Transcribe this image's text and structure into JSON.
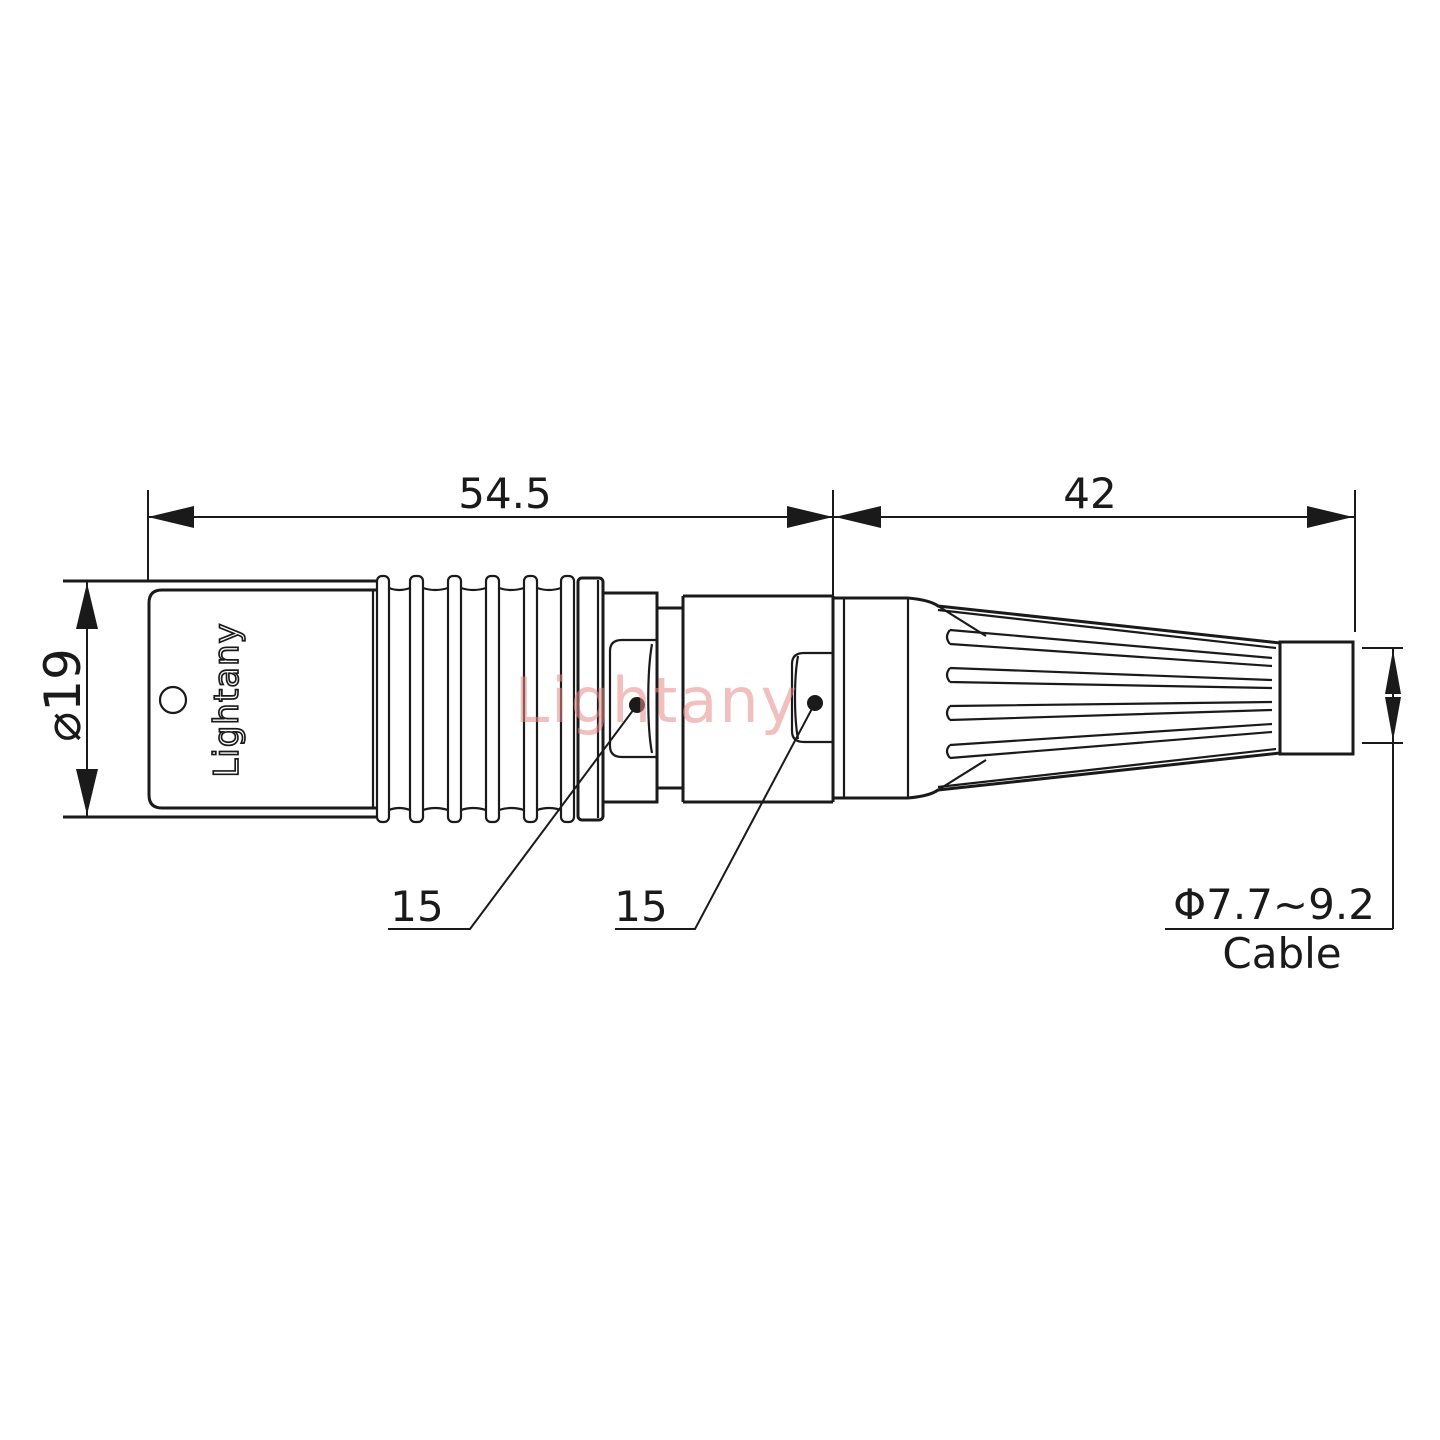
{
  "drawing": {
    "type": "connector-technical-drawing",
    "dimensions": {
      "front_length": "54.5",
      "rear_length": "42",
      "body_diameter": "⌀19",
      "latch_front": "15",
      "latch_rear": "15",
      "cable_range": "Φ7.7~9.2",
      "cable_label": "Cable"
    },
    "branding": {
      "body_text": "Lightany",
      "watermark": "Lightany"
    },
    "colors": {
      "line": "#1a1a1a",
      "watermark_pink": "#e78a8a",
      "background": "#ffffff"
    }
  }
}
